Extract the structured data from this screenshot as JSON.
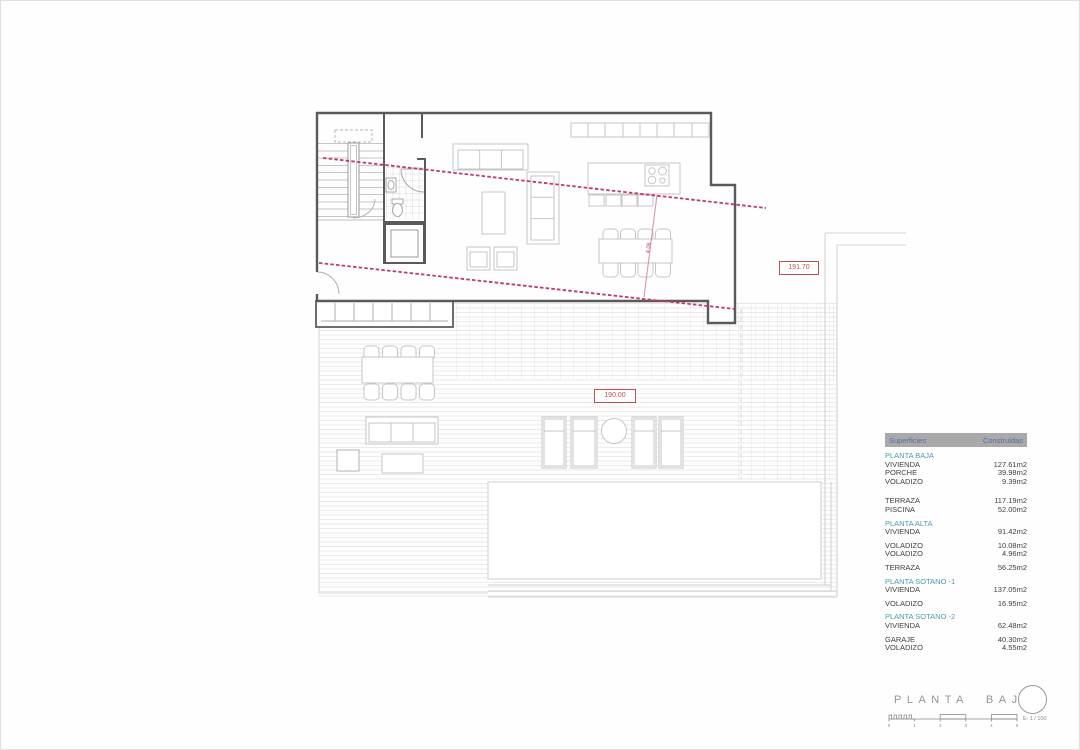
{
  "drawing": {
    "title": "PLANTA BAJA",
    "scale_label": "E: 1 / 100",
    "scale_numbers": [
      "0",
      "1",
      "2",
      "3",
      "4",
      "5"
    ]
  },
  "markers": {
    "level_upper": "191.70",
    "level_terrace": "190.00",
    "dim_diagonal": "4.06"
  },
  "colors": {
    "wall": "#5a5a5a",
    "furniture_line": "#c6c6c6",
    "deck_line": "#e6e6e6",
    "section_line_magenta": "#c23672",
    "level_marker_red": "#c0504d",
    "table_header_bg": "#a9a9a9",
    "table_header_text": "#50719c",
    "section_heading_teal": "#4d9ab3",
    "body_text": "#3e3e3e"
  },
  "surfaces_table": {
    "header": {
      "col1": "Superficies",
      "col2": "Construidas"
    },
    "sections": [
      {
        "heading": "PLANTA BAJA",
        "rows": [
          {
            "label": "VIVIENDA",
            "value": "127.61m2"
          },
          {
            "label": "PORCHE",
            "value": "39.98m2"
          },
          {
            "label": "VOLADIZO",
            "value": "9.39m2"
          },
          {
            "label": "TERRAZA",
            "value": "117.19m2",
            "gap": true
          },
          {
            "label": "PISCINA",
            "value": "52.00m2"
          }
        ]
      },
      {
        "heading": "PLANTA ALTA",
        "rows": [
          {
            "label": "VIVIENDA",
            "value": "91.42m2"
          },
          {
            "label": "VOLADIZO",
            "value": "10.08m2",
            "gap": true
          },
          {
            "label": "VOLADIZO",
            "value": "4.96m2"
          },
          {
            "label": "TERRAZA",
            "value": "56.25m2",
            "gap": true
          }
        ]
      },
      {
        "heading": "PLANTA SOTANO -1",
        "rows": [
          {
            "label": "VIVIENDA",
            "value": "137.05m2"
          },
          {
            "label": "VOLADIZO",
            "value": "16.95m2",
            "gap": true
          }
        ]
      },
      {
        "heading": "PLANTA SOTANO -2",
        "rows": [
          {
            "label": "VIVIENDA",
            "value": "62.48m2"
          },
          {
            "label": "GARAJE",
            "value": "40.30m2",
            "gap": true
          },
          {
            "label": "VOLADIZO",
            "value": "4.55m2"
          }
        ]
      }
    ]
  }
}
